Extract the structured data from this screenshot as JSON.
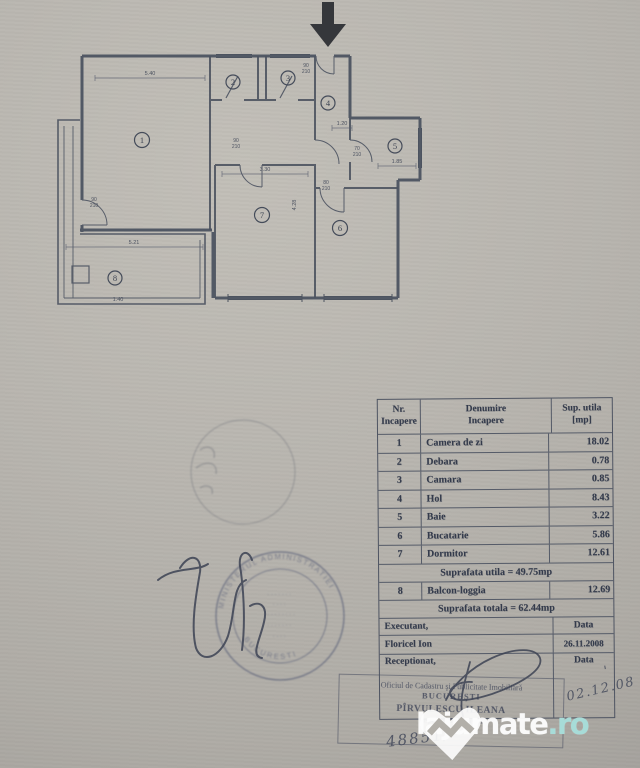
{
  "plan": {
    "rooms": [
      {
        "label": "1"
      },
      {
        "label": "2"
      },
      {
        "label": "3"
      },
      {
        "label": "4"
      },
      {
        "label": "5"
      },
      {
        "label": "6"
      },
      {
        "label": "7"
      },
      {
        "label": "8"
      }
    ],
    "dims": [
      {
        "text": "5.40"
      },
      {
        "text": "3.30"
      },
      {
        "text": "1.20"
      },
      {
        "text": "1.85"
      },
      {
        "text": "5.21"
      },
      {
        "text": "1.40"
      },
      {
        "text": "4.28"
      }
    ],
    "door_labels": [
      {
        "top": "90",
        "bottom": "210"
      },
      {
        "top": "90",
        "bottom": "210"
      },
      {
        "top": "80",
        "bottom": "210"
      },
      {
        "top": "70",
        "bottom": "210"
      },
      {
        "top": "90",
        "bottom": "210"
      }
    ]
  },
  "table": {
    "headers": {
      "col1_line1": "Nr.",
      "col1_line2": "Incapere",
      "col2_line1": "Denumire",
      "col2_line2": "Incapere",
      "col3_line1": "Sup. utila",
      "col3_line2": "[mp]"
    },
    "rows": [
      {
        "nr": "1",
        "name": "Camera de zi",
        "area": "18.02"
      },
      {
        "nr": "2",
        "name": "Debara",
        "area": "0.78"
      },
      {
        "nr": "3",
        "name": "Camara",
        "area": "0.85"
      },
      {
        "nr": "4",
        "name": "Hol",
        "area": "8.43"
      },
      {
        "nr": "5",
        "name": "Baie",
        "area": "3.22"
      },
      {
        "nr": "6",
        "name": "Bucatarie",
        "area": "5.86"
      },
      {
        "nr": "7",
        "name": "Dormitor",
        "area": "12.61"
      }
    ],
    "subtotal": "Suprafata utila = 49.75mp",
    "row8": {
      "nr": "8",
      "name": "Balcon-loggia",
      "area": "12.69"
    },
    "total": "Suprafata totala = 62.44mp",
    "executant_label": "Executant,",
    "executant_data_label": "Data",
    "executant_name": "Floricel Ion",
    "executant_date": "26.11.2008",
    "receptionat_label": "Receptionat,",
    "reception_data_label": "Data",
    "reception_date_handwritten": "02.12.08",
    "reception_tick": "'"
  },
  "stamps": {
    "round": {
      "arc_top": "MINISTERUL ADMINISTRATIEI",
      "arc_bottom": "BUCURESTI",
      "center_lines": [
        "·······",
        "····",
        "·········",
        "·······",
        "····"
      ]
    },
    "office": {
      "line1": "Oficiul de Cadastru şi Publicitate Imobiliară",
      "line2": "BUCUREŞTI",
      "name": "PÎRVULESCU ILEANA",
      "title": "Inspector de cadastru"
    },
    "registry_number": "48851/"
  },
  "watermark": {
    "brand": "lajumate",
    "tld": ".ro"
  }
}
